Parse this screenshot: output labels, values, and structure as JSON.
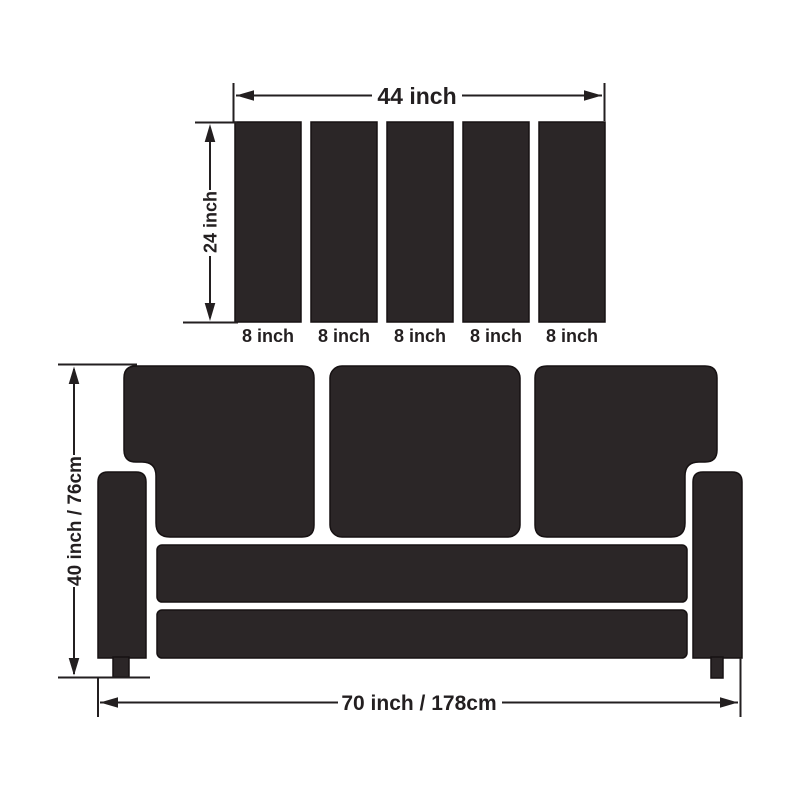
{
  "diagram_title": "sofa-cover-dimension-diagram",
  "colors": {
    "shape_fill": "#2b2627",
    "shape_stroke": "#161112",
    "line_color": "#231f20",
    "background": "#ffffff"
  },
  "panel_diagram": {
    "width_dim": "44 inch",
    "height_dim": "24 inch",
    "panel_count": 5,
    "panel_width_dims": [
      "8 inch",
      "8 inch",
      "8 inch",
      "8 inch",
      "8 inch"
    ]
  },
  "sofa_diagram": {
    "height_dim": "40 inch / 76cm",
    "width_dim": "70 inch / 178cm",
    "back_cushion_count": 3
  }
}
